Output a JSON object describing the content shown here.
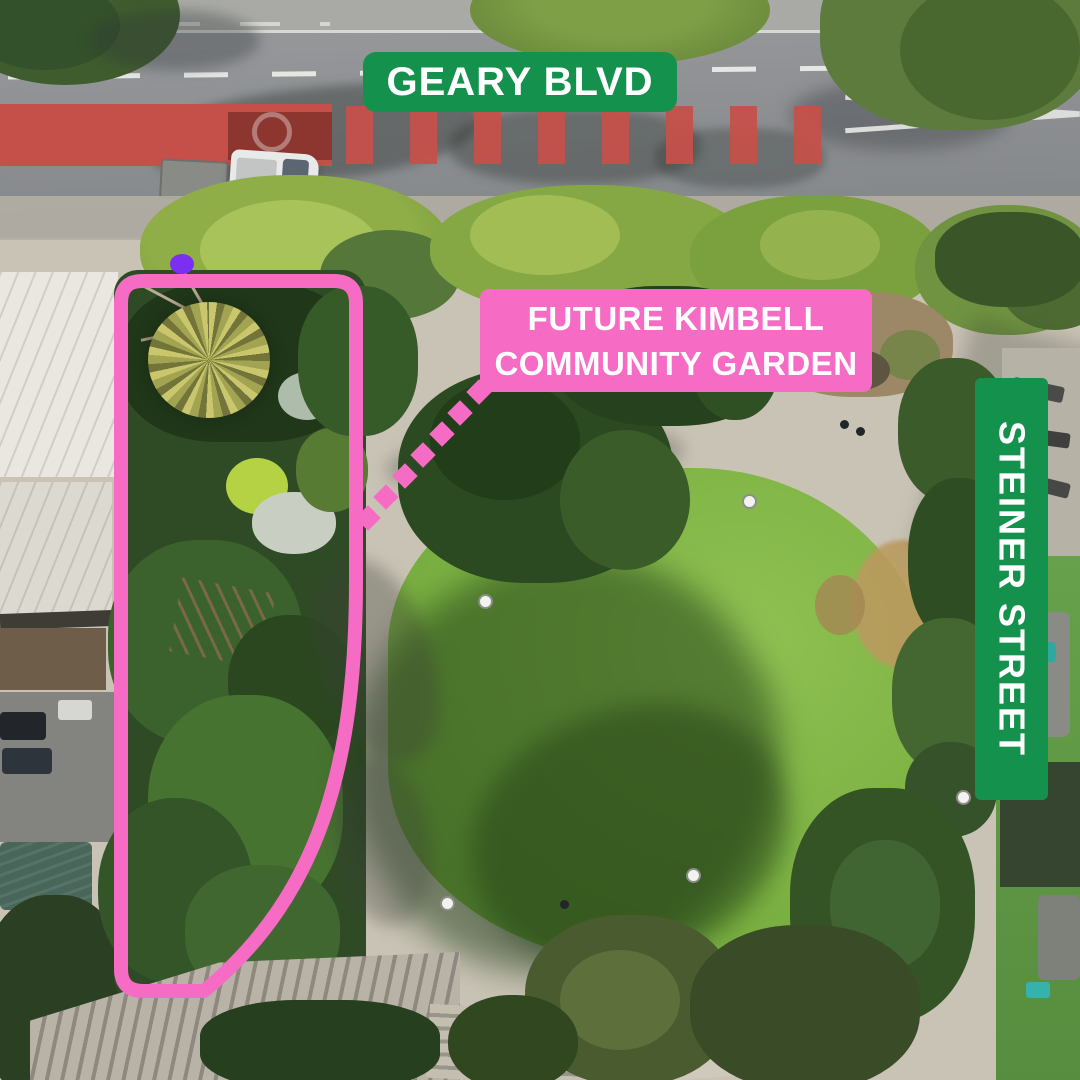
{
  "annotations": {
    "geary_blvd_label": "GEARY BLVD",
    "steiner_street_label": "STEINER STREET",
    "garden_label_line1": "FUTURE KIMBELL",
    "garden_label_line2": "COMMUNITY GARDEN"
  },
  "colors": {
    "label_green": "#15914E",
    "highlight_pink": "#F66BC4",
    "marker_purple": "#7B2FF1",
    "label_text": "#FFFFFF"
  },
  "icons": {
    "site_outline": "pink-rounded-site-outline",
    "connector": "pink-dotted-diamond-connector",
    "marker": "purple-dot-marker"
  }
}
